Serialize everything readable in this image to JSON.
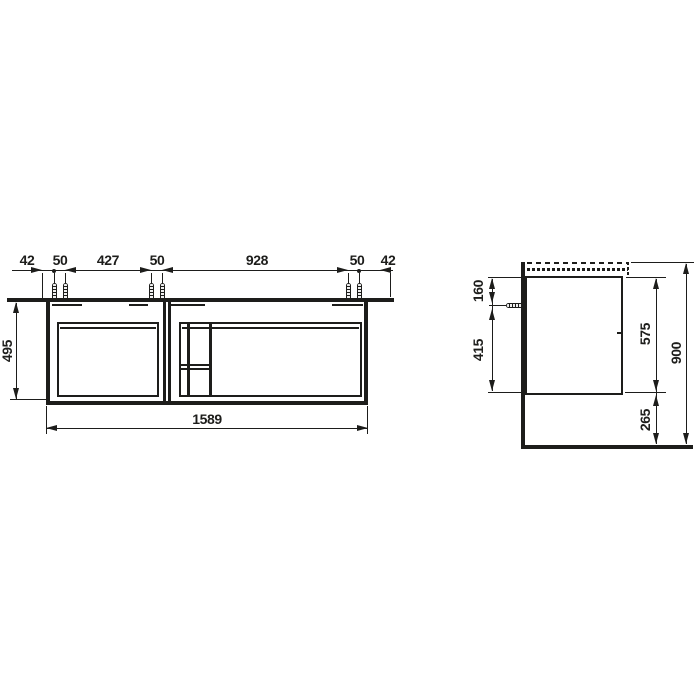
{
  "drawing": {
    "line_color": "#1d1d1b",
    "front_view": {
      "top_dims": [
        "42",
        "50",
        "427",
        "50",
        "928",
        "50",
        "42"
      ],
      "height": "495",
      "width": "1589"
    },
    "side_view": {
      "top_to_screw": "160",
      "screw_to_bottom": "415",
      "body_height": "575",
      "floor_clearance": "265",
      "total_height": "900"
    }
  }
}
